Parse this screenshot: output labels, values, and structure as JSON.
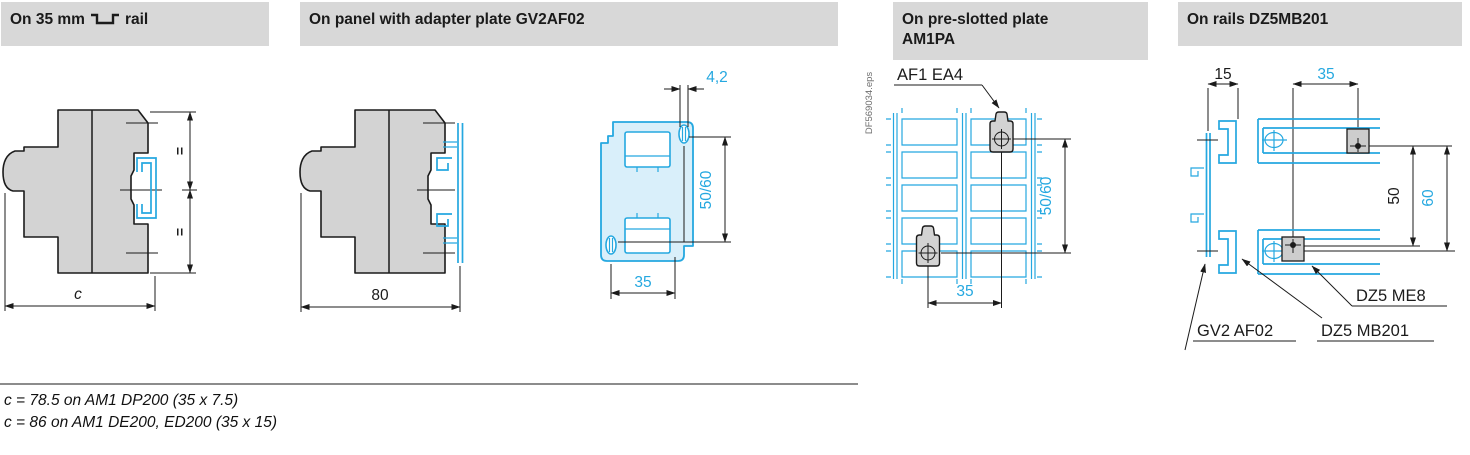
{
  "colors": {
    "accent_cyan": "#25A8E0",
    "plate_fill": "#D9EFFA",
    "device_gray": "#D3D3D3",
    "header_bg": "#D8D8D8",
    "line_black": "#1B1B1B"
  },
  "headers": [
    {
      "prefix": "On 35 mm",
      "suffix": "rail",
      "icon": "din-rail-profile"
    },
    {
      "label": "On panel with adapter plate GV2AF02"
    },
    {
      "line1": "On pre-slotted plate",
      "line2": "AM1PA"
    },
    {
      "label": "On rails DZ5MB201"
    }
  ],
  "diagrams": {
    "din_rail_side": {
      "equal_mark_top": "=",
      "equal_mark_bottom": "=",
      "width_dim": "c"
    },
    "adapter_plate_side": {
      "width_dim": "80"
    },
    "adapter_plate_front": {
      "hole_dim": "4,2",
      "vertical_dim": "50/60",
      "horizontal_dim": "35"
    },
    "preslotted_plate": {
      "file_ref": "DF569034.eps",
      "clip_label": "AF1 EA4",
      "vertical_dim": "50/60",
      "horizontal_dim": "35"
    },
    "rails": {
      "rail_depth_dim": "15",
      "rail_pitch_dim": "35",
      "spacing_dim_a": "50",
      "spacing_dim_b": "60",
      "label_nut": "DZ5 ME8",
      "label_plate": "GV2 AF02",
      "label_rail": "DZ5 MB201"
    }
  },
  "notes": {
    "line1": "c = 78.5 on AM1 DP200 (35 x 7.5)",
    "line2": "c = 86 on AM1 DE200, ED200 (35 x 15)"
  }
}
